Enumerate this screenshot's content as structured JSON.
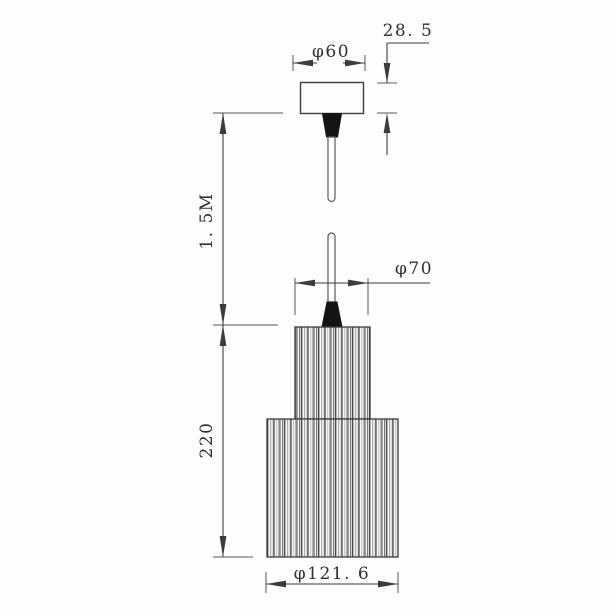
{
  "colors": {
    "line": "#3c3c3c",
    "text": "#2f2f2f",
    "grip": "#141414",
    "background": "#fdfdfd"
  },
  "drawing": {
    "dimensions": {
      "canopy_height": {
        "label": "28. 5"
      },
      "canopy_diameter": {
        "label": "φ60"
      },
      "cable_length": {
        "label": "1. 5M"
      },
      "shade_top_diameter": {
        "label": "φ70"
      },
      "shade_height": {
        "label": "220"
      },
      "shade_bottom_diameter": {
        "label": "φ121. 6"
      }
    }
  }
}
